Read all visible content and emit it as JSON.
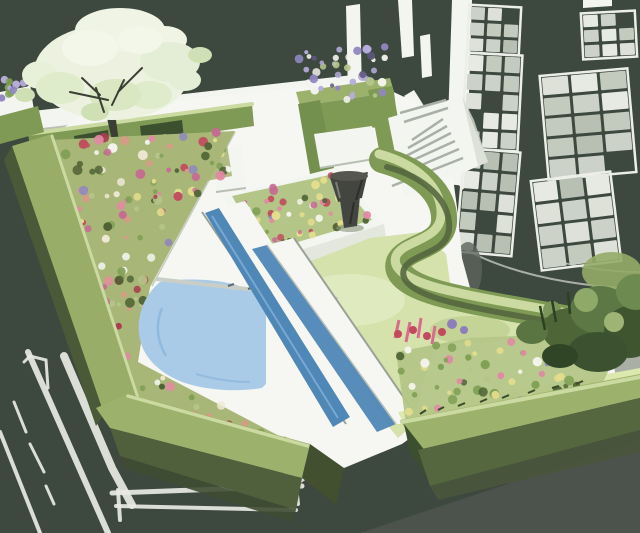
{
  "figure": {
    "alt": "Watercolor concept illustration of a walled courtyard garden: clipped box hedges, flower borders, a blossoming specimen tree, central flower bed with stone urn, a rill and curved pool, lawn with serpentine hedge, stone steps and a tall house facade with casement windows"
  },
  "palette": {
    "background": "#3d483e",
    "ground_shadow": "#4c534d",
    "wall_white": "#f3f5f0",
    "patio_white": "#f6f7f3",
    "window_frame": "#eceee8",
    "sketch_line": "#e7eae3",
    "hedge_top": "#9cb26c",
    "hedge_light": "#cbdaa1",
    "hedge_mid": "#7e9a54",
    "hedge_dark": "#55673f",
    "hedge_deep": "#3c4f2e",
    "lawn": "#d5e2ab",
    "lawn_light": "#e2ecc4",
    "pool": "#a9cbe7",
    "pool_deep": "#8ab4dc",
    "rill": "#4f87b7",
    "rill_light": "#7fb0d8",
    "bed_base": "#a8b678",
    "bed_base2": "#b4c687",
    "leaf_light": "#b5c68a",
    "leaf_mid": "#7fa054",
    "leaf_dark": "#4e6234",
    "flower_pink": "#e289a3",
    "flower_red": "#c04f5f",
    "flower_crimson": "#a93d50",
    "flower_yellow": "#e4dd8d",
    "flower_cream": "#efe9d6",
    "flower_purple": "#9187c0",
    "flower_lavender": "#b7addb",
    "flower_violet_dark": "#5e5680",
    "flower_salmon": "#d89a87",
    "flower_magenta": "#c76a94",
    "flower_white": "#f4f4ee",
    "tree_foliage": "#ecf2df",
    "tree_foliage_shade": "#d9e7c2",
    "trunk": "#3a3e34",
    "urn": "#434540",
    "urn_dark": "#2d2e2a",
    "gray_mid": "#a9afa5",
    "gray_dark": "#8d948a"
  },
  "pane_shades": [
    "#ccd2c8",
    "#dde1d7",
    "#b8bfb3",
    "#e7eae3",
    "#c3cabe"
  ],
  "windows": [
    {
      "x": 470,
      "y": 8,
      "w": 48,
      "h": 44,
      "cols": 3,
      "rows": 3,
      "rot": 3
    },
    {
      "x": 466,
      "y": 56,
      "w": 52,
      "h": 92,
      "cols": 3,
      "rows": 5,
      "rot": 3
    },
    {
      "x": 462,
      "y": 152,
      "w": 52,
      "h": 100,
      "cols": 3,
      "rows": 5,
      "rot": 5
    },
    {
      "x": 584,
      "y": 14,
      "w": 50,
      "h": 42,
      "cols": 3,
      "rows": 3,
      "rot": -3
    },
    {
      "x": 546,
      "y": 74,
      "w": 84,
      "h": 100,
      "cols": 3,
      "rows": 5,
      "rot": -5
    },
    {
      "x": 538,
      "y": 178,
      "w": 76,
      "h": 86,
      "cols": 3,
      "rows": 4,
      "rot": -7
    }
  ],
  "scatter": [
    {
      "target": "dots-left-border",
      "n": 160,
      "rmin": 2,
      "rmax": 5,
      "seed": 7,
      "polygon": [
        [
          50,
          140
        ],
        [
          235,
          131
        ],
        [
          150,
          287
        ],
        [
          138,
          362
        ],
        [
          310,
          452
        ],
        [
          344,
          470
        ],
        [
          115,
          424
        ]
      ],
      "colors": [
        "flower_pink",
        "flower_red",
        "flower_crimson",
        "flower_yellow",
        "flower_salmon",
        "flower_magenta",
        "flower_purple",
        "flower_white",
        "flower_cream",
        "leaf_light",
        "leaf_mid",
        "leaf_dark",
        "leaf_mid"
      ]
    },
    {
      "target": "dots-tree-bed",
      "n": 90,
      "rmin": 2,
      "rmax": 5,
      "seed": 13,
      "polygon": [
        [
          34,
          150
        ],
        [
          225,
          132
        ],
        [
          232,
          176
        ],
        [
          150,
          192
        ],
        [
          60,
          206
        ]
      ],
      "colors": [
        "flower_pink",
        "flower_red",
        "flower_crimson",
        "flower_white",
        "flower_salmon",
        "flower_yellow",
        "leaf_mid",
        "leaf_dark",
        "leaf_light"
      ]
    },
    {
      "target": "dots-central-bed",
      "n": 60,
      "rmin": 2,
      "rmax": 4.5,
      "seed": 29,
      "polygon": [
        [
          232,
          196
        ],
        [
          334,
          174
        ],
        [
          372,
          220
        ],
        [
          264,
          252
        ]
      ],
      "colors": [
        "flower_pink",
        "flower_magenta",
        "flower_purple",
        "flower_white",
        "flower_red",
        "flower_yellow",
        "leaf_mid",
        "leaf_light",
        "leaf_dark"
      ]
    },
    {
      "target": "dots-br-bed",
      "n": 70,
      "rmin": 2,
      "rmax": 5,
      "seed": 41,
      "polygon": [
        [
          396,
          352
        ],
        [
          470,
          338
        ],
        [
          560,
          334
        ],
        [
          618,
          352
        ],
        [
          594,
          400
        ],
        [
          470,
          418
        ],
        [
          406,
          424
        ]
      ],
      "colors": [
        "leaf_mid",
        "leaf_light",
        "leaf_dark",
        "flower_pink",
        "flower_white",
        "flower_purple",
        "flower_yellow",
        "leaf_mid"
      ]
    },
    {
      "target": "dots-purple-planter",
      "n": 42,
      "rmin": 2,
      "rmax": 4.5,
      "seed": 53,
      "polygon": [
        [
          298,
          52
        ],
        [
          386,
          44
        ],
        [
          392,
          96
        ],
        [
          304,
          104
        ]
      ],
      "colors": [
        "flower_lavender",
        "flower_purple",
        "flower_violet_dark",
        "flower_white",
        "leaf_light"
      ]
    },
    {
      "target": "dots-corner-left",
      "n": 14,
      "rmin": 2,
      "rmax": 4,
      "seed": 61,
      "polygon": [
        [
          0,
          74
        ],
        [
          30,
          68
        ],
        [
          34,
          94
        ],
        [
          0,
          100
        ]
      ],
      "colors": [
        "flower_lavender",
        "flower_purple",
        "leaf_mid",
        "flower_white"
      ]
    }
  ],
  "scene": {
    "elements": [
      "background",
      "ground-sketch-lines",
      "house-facade",
      "casement-windows",
      "curved-terrace-wall",
      "garden-wall",
      "back-hedge",
      "blossom-tree",
      "lavender-planter",
      "hedge-bench",
      "flower-borders",
      "patio",
      "central-flower-bed",
      "stone-urn",
      "stone-steps",
      "rill",
      "pool",
      "lawn",
      "serpentine-hedge",
      "shrub-border",
      "boundary-hedges"
    ]
  }
}
